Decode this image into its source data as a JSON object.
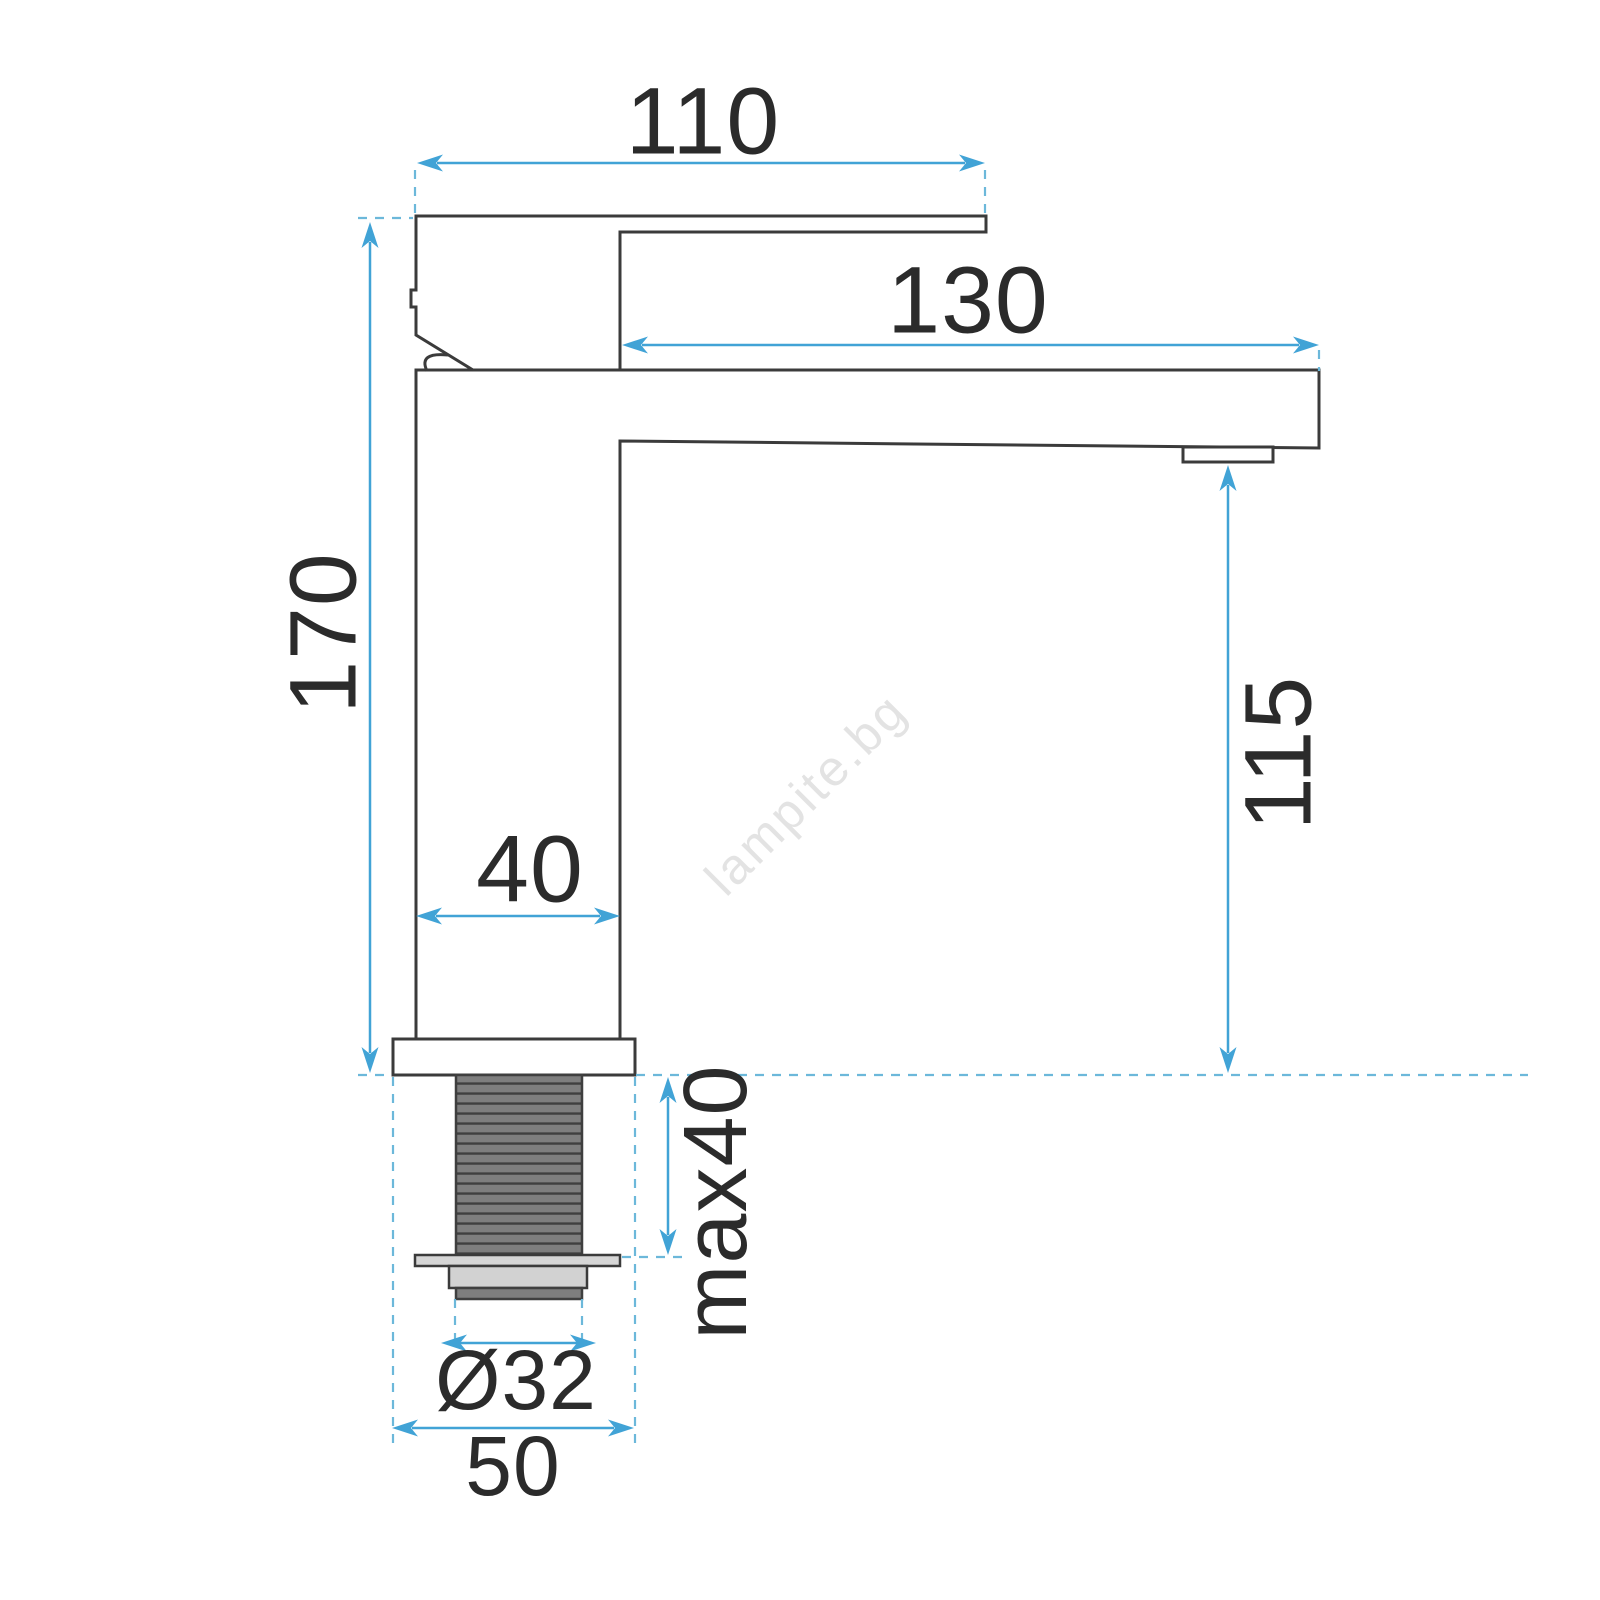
{
  "diagram": {
    "type": "faucet-technical-drawing",
    "dimensions": {
      "handle_top_width": "110",
      "spout_reach": "130",
      "total_height": "170",
      "spout_height": "115",
      "body_width": "40",
      "mounting_depth": "max40",
      "thread_diameter": "Ø32",
      "base_width": "50"
    },
    "watermark": "lampite.bg",
    "colors": {
      "outline": "#3b3b3b",
      "dimension_line": "#41a3d6",
      "extension_line": "#6cb8da",
      "thread_fill": "#7e7e7e",
      "thread_stripe": "#3f3f3f",
      "fitting_fill": "#d6d6d6",
      "label_text": "#2b2b2b",
      "watermark_gray": "#e3e3e3"
    }
  }
}
